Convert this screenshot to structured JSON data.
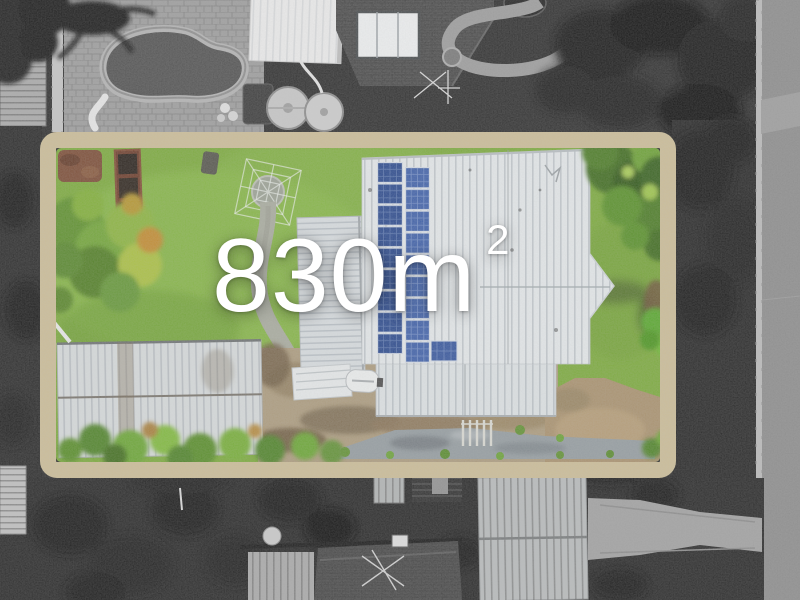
{
  "overlay": {
    "area_value": "830m",
    "area_exponent": "2",
    "area_full": "830m²"
  },
  "palette": {
    "lot_border": "#cbbc96",
    "grass": "#7aa93a",
    "roof_white": "#e4e8ea",
    "solar_panel": "#2b4b91",
    "road": "#8b8b8b",
    "driveway": "#a8906c",
    "pool_water": "#4f4f4f",
    "text": "#ffffff"
  },
  "features": [
    "property-lot-boundary",
    "lawn",
    "main-house-roof",
    "solar-panel-array",
    "garden-shed-roof",
    "clothesline",
    "concrete-path",
    "driveway",
    "neighbor-pool",
    "neighbor-roofs",
    "street"
  ]
}
